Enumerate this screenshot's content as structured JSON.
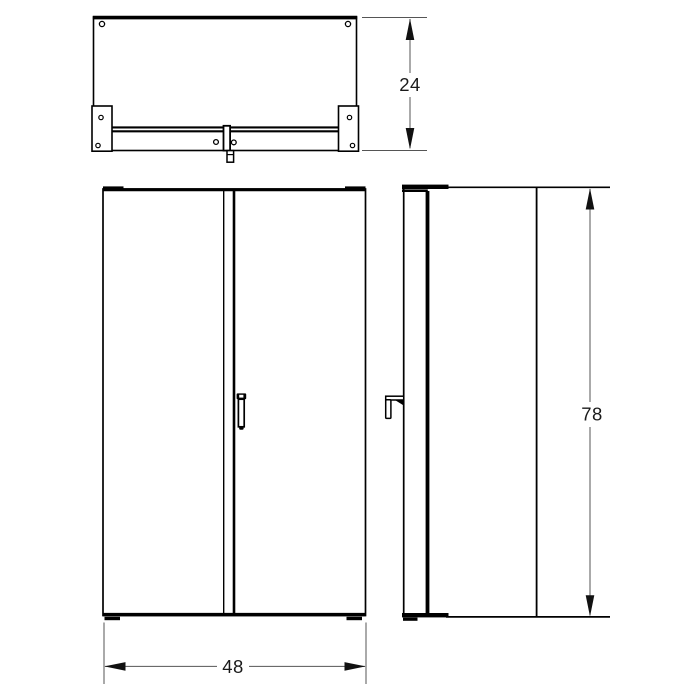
{
  "drawing": {
    "dimensions": {
      "depth": "24",
      "width": "48",
      "height": "78"
    },
    "colors": {
      "line": "#000000",
      "dimension_line": "#555555",
      "text": "#1a1a1a",
      "background": "#ffffff"
    }
  }
}
